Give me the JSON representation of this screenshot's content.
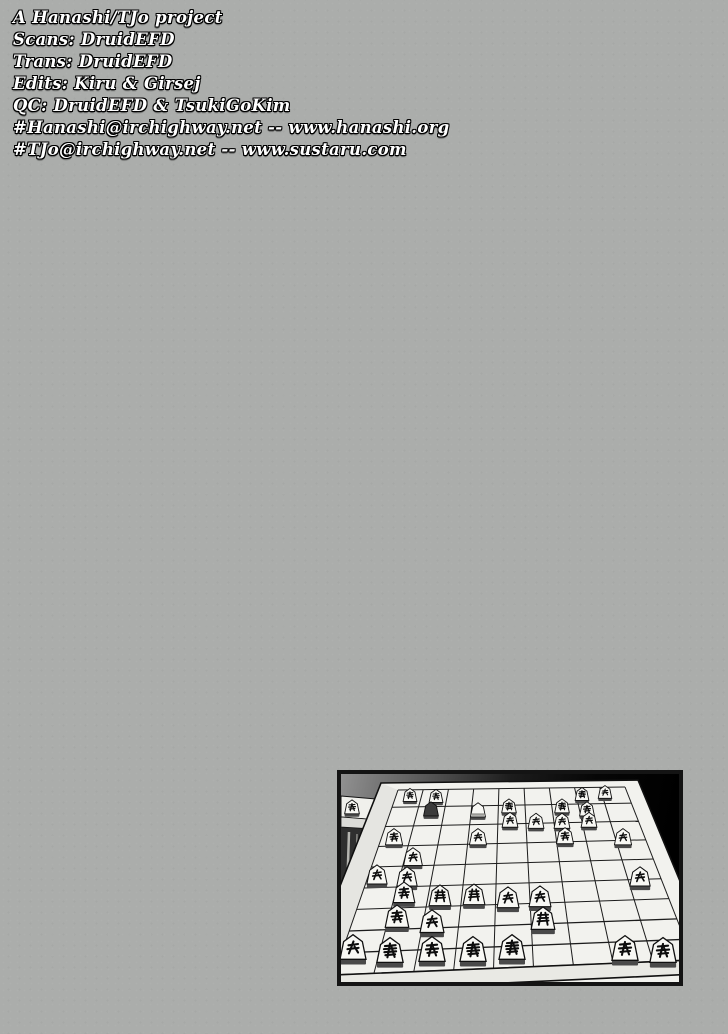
{
  "page": {
    "background_color": "#abadab",
    "kind": "manga scanlation credits page"
  },
  "credits": {
    "text_color": "#ffffff",
    "outline_color": "#000000",
    "lines": [
      "A Hanashi/TJo project",
      "Scans: DruidEFD",
      "Trans: DruidEFD",
      "Edits: Kiru & Girsej",
      "QC: DruidEFD & TsukiGoKim",
      "#Hanashi@irchighway.net -- www.hanashi.org",
      "#TJo@irchighway.net -- www.sustaru.com"
    ]
  },
  "panel": {
    "description": "manga panel: shogi board in perspective on a dark room background, small table with a captured piece at left",
    "border_color": "#141414",
    "wall_color_left": "#919191",
    "wall_color_right": "#000000",
    "board_color": "#f2f2ee",
    "board_rim_color": "#e9e9e4",
    "grid_color": "#1c1c1c",
    "piece_color": "#f8f8f4",
    "piece_dark_color": "#3c3c3c",
    "piece_base_color": "#4a4a4a",
    "table_top_color": "#f0f0ec",
    "table_front_color": "#dcdcd8",
    "table_shadow_color": "#2f2f2f",
    "grid": {
      "far_left": [
        57,
        16
      ],
      "far_right": [
        284,
        13
      ],
      "near_left": [
        -7,
        201
      ],
      "near_right": [
        352,
        186
      ],
      "cols": 9,
      "rows": 9,
      "row_power": 1.08
    },
    "pieces": [
      {
        "x": 11,
        "y": 34,
        "type": "knight"
      },
      {
        "x": 69,
        "y": 22,
        "type": "knight"
      },
      {
        "x": 95,
        "y": 23,
        "type": "silver"
      },
      {
        "x": 90,
        "y": 36,
        "type": "gold-dark"
      },
      {
        "x": 137,
        "y": 37,
        "type": "pawn-back"
      },
      {
        "x": 168,
        "y": 33,
        "type": "king"
      },
      {
        "x": 221,
        "y": 33,
        "type": "gold"
      },
      {
        "x": 246,
        "y": 36,
        "type": "silver"
      },
      {
        "x": 241,
        "y": 21,
        "type": "gold"
      },
      {
        "x": 264,
        "y": 19,
        "type": "lance"
      },
      {
        "x": 169,
        "y": 47,
        "type": "pawn"
      },
      {
        "x": 195,
        "y": 48,
        "type": "pawn"
      },
      {
        "x": 221,
        "y": 48,
        "type": "pawn"
      },
      {
        "x": 248,
        "y": 47,
        "type": "pawn"
      },
      {
        "x": 53,
        "y": 64,
        "type": "knight"
      },
      {
        "x": 137,
        "y": 64,
        "type": "pawn"
      },
      {
        "x": 224,
        "y": 63,
        "type": "knight"
      },
      {
        "x": 282,
        "y": 64,
        "type": "lance"
      },
      {
        "x": 72,
        "y": 84,
        "type": "pawn"
      },
      {
        "x": 36,
        "y": 102,
        "type": "pawn"
      },
      {
        "x": 66,
        "y": 104,
        "type": "pawn"
      },
      {
        "x": 299,
        "y": 104,
        "type": "pawn"
      },
      {
        "x": 63,
        "y": 120,
        "type": "silver"
      },
      {
        "x": 99,
        "y": 123,
        "type": "bishop"
      },
      {
        "x": 133,
        "y": 122,
        "type": "rook"
      },
      {
        "x": 167,
        "y": 125,
        "type": "pawn"
      },
      {
        "x": 199,
        "y": 124,
        "type": "pawn"
      },
      {
        "x": 56,
        "y": 144,
        "type": "silver"
      },
      {
        "x": 91,
        "y": 149,
        "type": "pawn"
      },
      {
        "x": 202,
        "y": 146,
        "type": "rook"
      },
      {
        "x": 12,
        "y": 175,
        "type": "lance"
      },
      {
        "x": 49,
        "y": 178,
        "type": "king"
      },
      {
        "x": 91,
        "y": 177,
        "type": "silver"
      },
      {
        "x": 132,
        "y": 177,
        "type": "gold"
      },
      {
        "x": 171,
        "y": 175,
        "type": "gold"
      },
      {
        "x": 284,
        "y": 176,
        "type": "silver"
      },
      {
        "x": 322,
        "y": 178,
        "type": "knight"
      }
    ]
  }
}
